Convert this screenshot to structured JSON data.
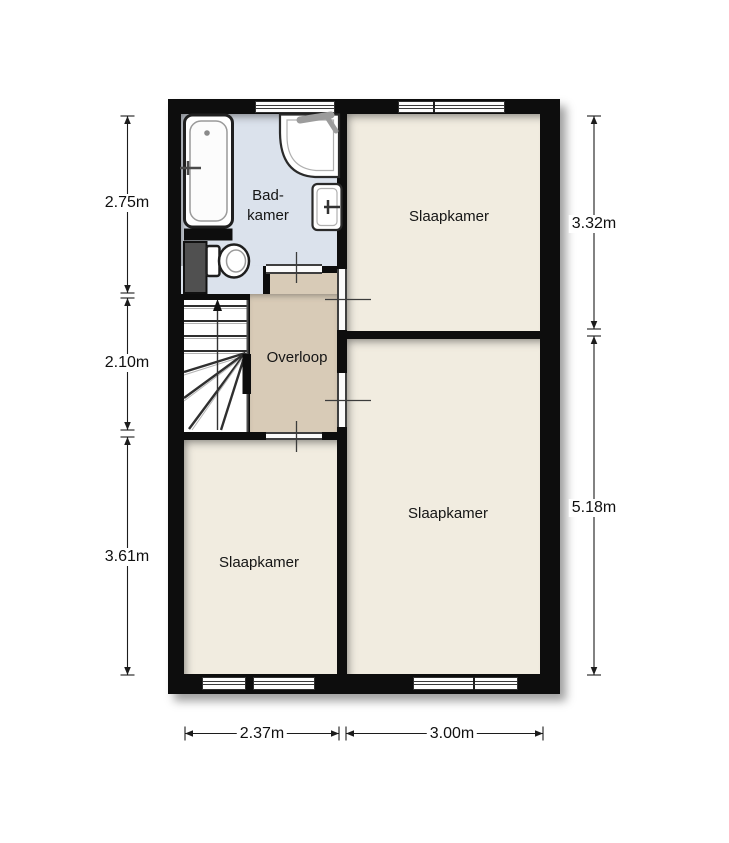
{
  "rooms": {
    "badkamer": {
      "label_line1": "Bad-",
      "label_line2": "kamer"
    },
    "slaapkamer_top_right": {
      "label": "Slaapkamer"
    },
    "overloop": {
      "label": "Overloop"
    },
    "slaapkamer_bottom_left": {
      "label": "Slaapkamer"
    },
    "slaapkamer_bottom_right": {
      "label": "Slaapkamer"
    }
  },
  "dimensions": {
    "left_top": {
      "label": "2.75m"
    },
    "left_middle": {
      "label": "2.10m"
    },
    "left_bottom": {
      "label": "3.61m"
    },
    "right_top": {
      "label": "3.32m"
    },
    "right_bottom": {
      "label": "5.18m"
    },
    "bottom_left": {
      "label": "2.37m"
    },
    "bottom_right": {
      "label": "3.00m"
    }
  },
  "fixtures": {
    "bathtub": "bathtub",
    "toilet": "toilet",
    "corner_washbasin": "corner washbasin",
    "washbasin": "washbasin",
    "stairs": "stairs up",
    "shaft": "duct shaft"
  },
  "colors": {
    "wall": "#0d0d0d",
    "bathroom_floor": "#dbe2ec",
    "landing_floor": "#d8cbb7",
    "bedroom_floor": "#f1ece0",
    "stairwell_floor": "#ffffff",
    "shaft_fill": "#505050",
    "background": "#ffffff"
  }
}
